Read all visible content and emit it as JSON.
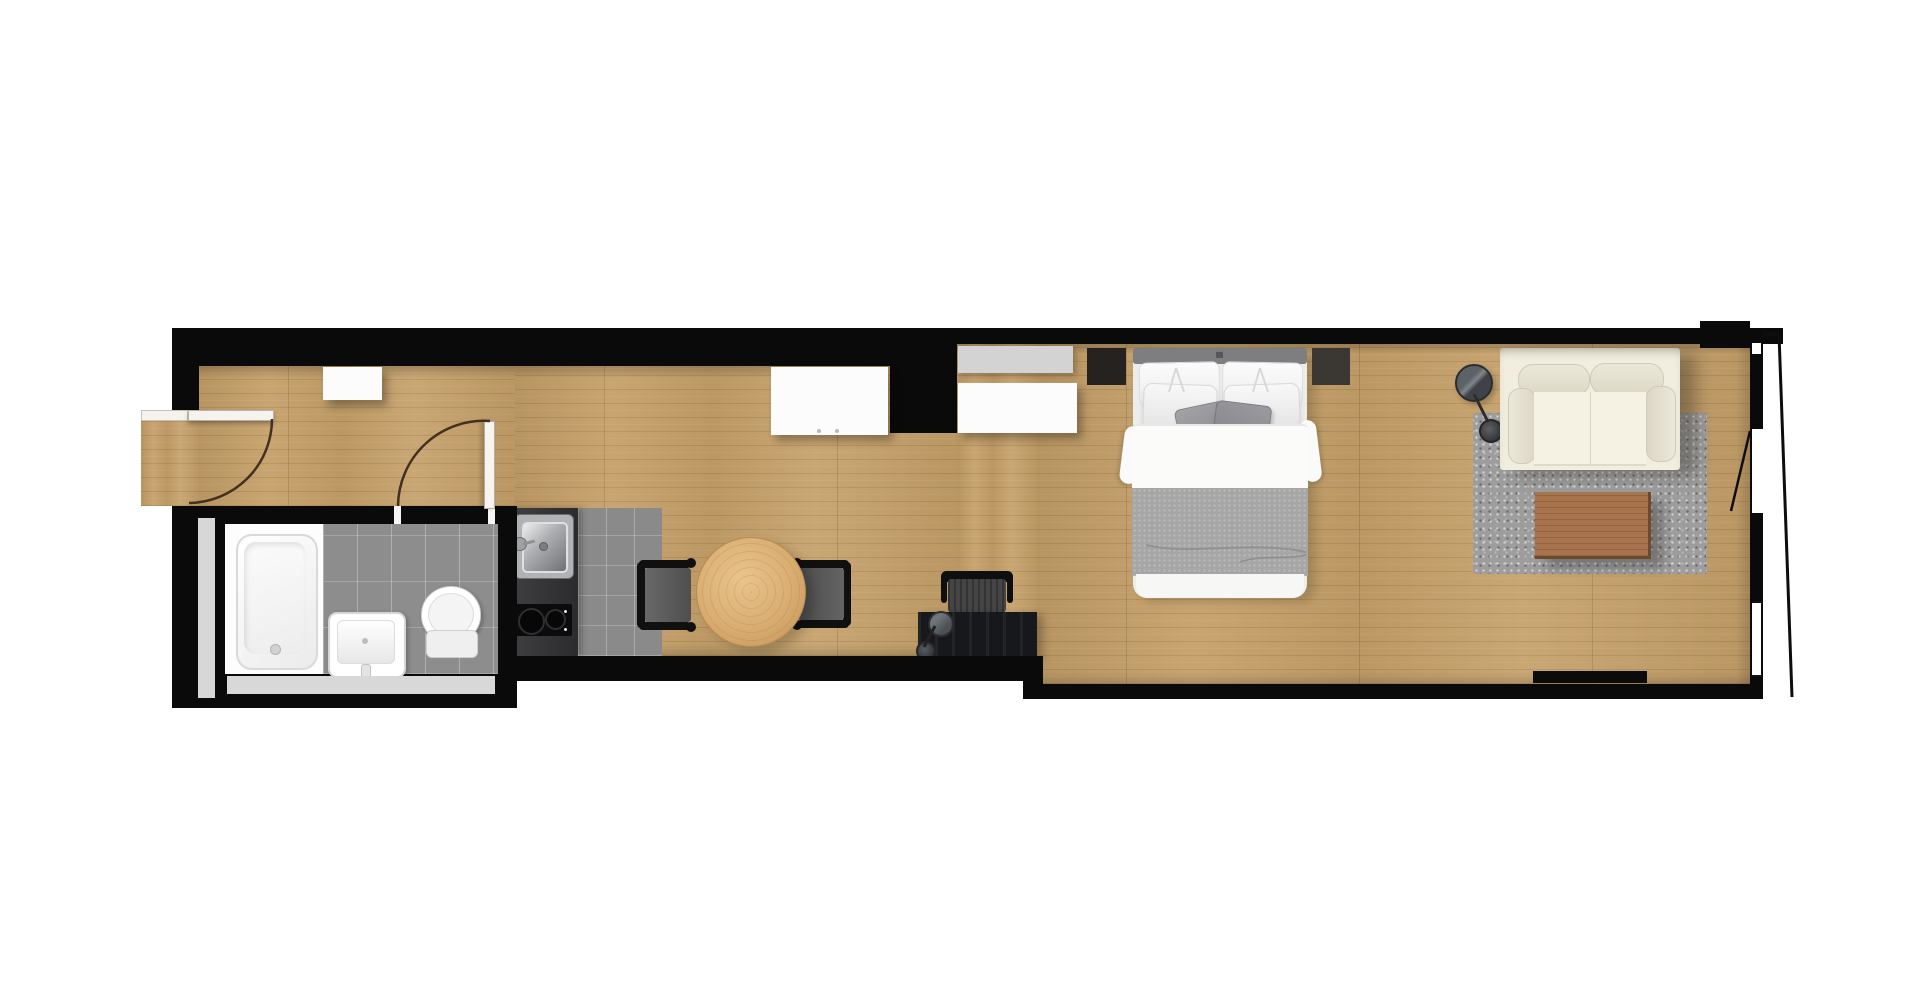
{
  "scene": {
    "type": "floor-plan",
    "view": "top-down",
    "unit": "studio-apartment"
  },
  "palette": {
    "background": "#ffffff",
    "wall": "#0a0a0a",
    "wood_floor": "#c5a069",
    "tile_gray": "#8d8d8d",
    "rug_gray": "#9d9d9d",
    "sofa_cream": "#f1eddf",
    "dining_table_wood": "#d9ad72",
    "coffee_table_wood": "#a9744d",
    "bed_blanket_gray": "#a6a6a6",
    "bed_linen_white": "#f9f9f9",
    "counter_dark": "#353538",
    "fixture_white": "#fdfdfd",
    "door_arc_brown": "#42311f"
  },
  "rooms": {
    "entry_hall": {
      "elements": [
        "entry-door",
        "entry-threshold",
        "wall-shelf"
      ]
    },
    "bathroom": {
      "elements": [
        "bathroom-door",
        "bathtub",
        "washbasin",
        "toilet",
        "tiled-floor",
        "side-ledge"
      ]
    },
    "kitchen": {
      "elements": [
        "kitchen-counter",
        "kitchen-sink",
        "cooktop",
        "tiled-floor"
      ]
    },
    "dining_area": {
      "elements": [
        "round-dining-table",
        "dining-chair-left",
        "dining-chair-right"
      ]
    },
    "work_area": {
      "elements": [
        "desk",
        "desk-chair",
        "desk-lamp"
      ]
    },
    "sleeping_area": {
      "elements": [
        "double-bed",
        "headboard",
        "pillows",
        "accent-pillows",
        "duvet",
        "blanket",
        "nightstand-left",
        "nightstand-right",
        "wardrobe-alcove",
        "dresser",
        "closet-shelf",
        "closet-cabinet"
      ]
    },
    "living_area": {
      "elements": [
        "sofa",
        "coffee-table",
        "area-rug",
        "floor-lamp",
        "radiator"
      ]
    },
    "facade": {
      "elements": [
        "balcony-door",
        "window-right",
        "balcony-edge-line"
      ]
    }
  }
}
